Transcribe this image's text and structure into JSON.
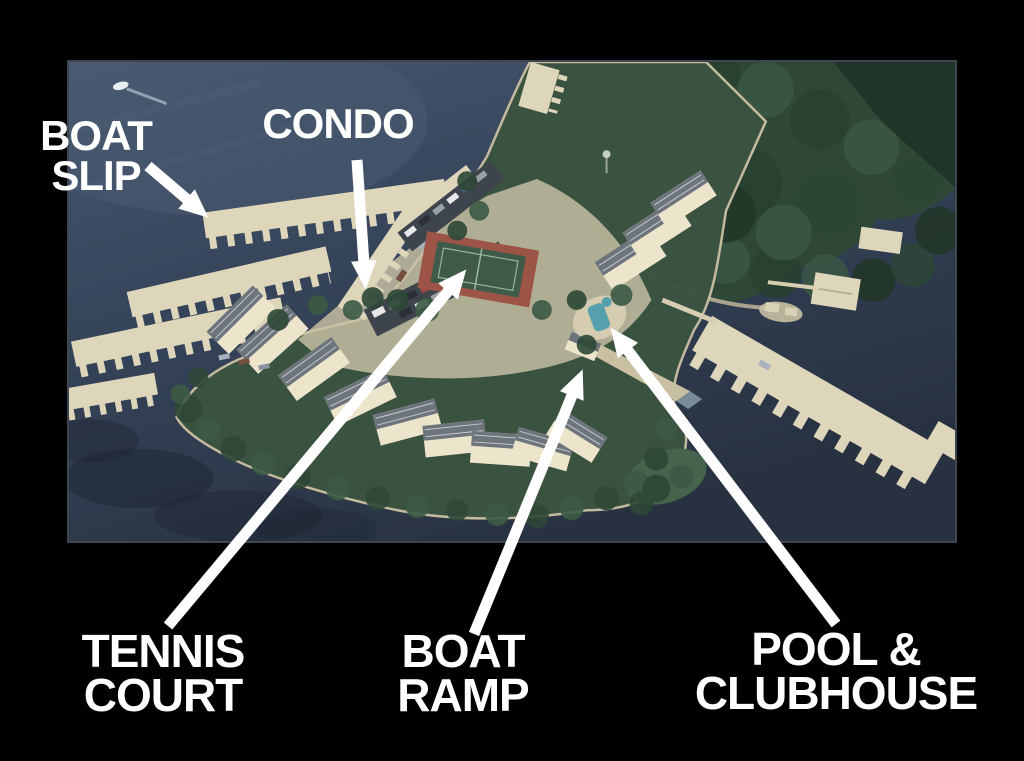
{
  "canvas": {
    "width": 1024,
    "height": 761,
    "background": "#000000"
  },
  "photo": {
    "description": "aerial-photo-lakeside-condo-peninsula",
    "x": 67,
    "y": 60,
    "width": 890,
    "height": 483,
    "colors": {
      "water": "#43536a",
      "water_deep": "#273140",
      "forest": "#2e4737",
      "land": "#3b5340",
      "ground_tan": "#cdc4a8",
      "dock_cream": "#ded6bb",
      "building_wall": "#ece4cb",
      "building_roof": "#6e747b",
      "tennis_red": "#9c5447",
      "tennis_green": "#3f5a49",
      "pool_teal": "#55a0ac",
      "parking": "#3e444c",
      "photo_border": "#3f4650"
    }
  },
  "annotations": {
    "color": "#ffffff",
    "items": [
      {
        "id": "boat-slip",
        "lines": [
          "BOAT",
          "SLIP"
        ]
      },
      {
        "id": "condo",
        "lines": [
          "CONDO"
        ]
      },
      {
        "id": "tennis-court",
        "lines": [
          "TENNIS",
          "COURT"
        ]
      },
      {
        "id": "boat-ramp",
        "lines": [
          "BOAT",
          "RAMP"
        ]
      },
      {
        "id": "pool-clubhouse",
        "lines": [
          "POOL &",
          "CLUBHOUSE"
        ]
      }
    ]
  }
}
